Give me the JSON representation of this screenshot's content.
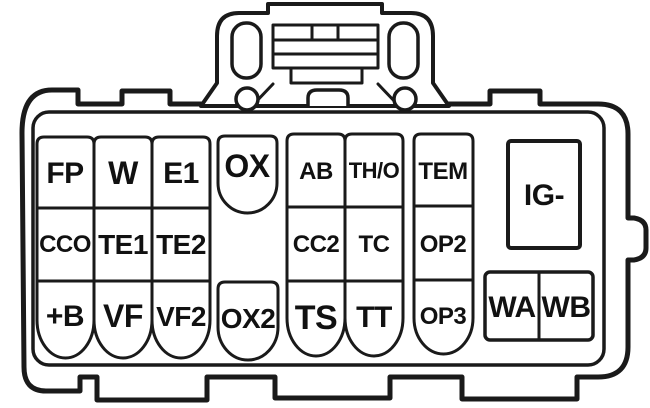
{
  "diagram_type": "connector-pinout",
  "colors": {
    "line": "#1a1a1a",
    "background": "#ffffff",
    "text": "#111111"
  },
  "terminals": {
    "fp": "FP",
    "w": "W",
    "e1": "E1",
    "ox": "OX",
    "ab": "AB",
    "th_o": "TH/O",
    "tem": "TEM",
    "ig_minus": "IG-",
    "cco": "CCO",
    "te1": "TE1",
    "te2": "TE2",
    "cc2": "CC2",
    "tc": "TC",
    "op2": "OP2",
    "plus_b": "+B",
    "vf": "VF",
    "vf2": "VF2",
    "ox2": "OX2",
    "ts": "TS",
    "tt": "TT",
    "op3": "OP3",
    "wa": "WA",
    "wb": "WB"
  }
}
